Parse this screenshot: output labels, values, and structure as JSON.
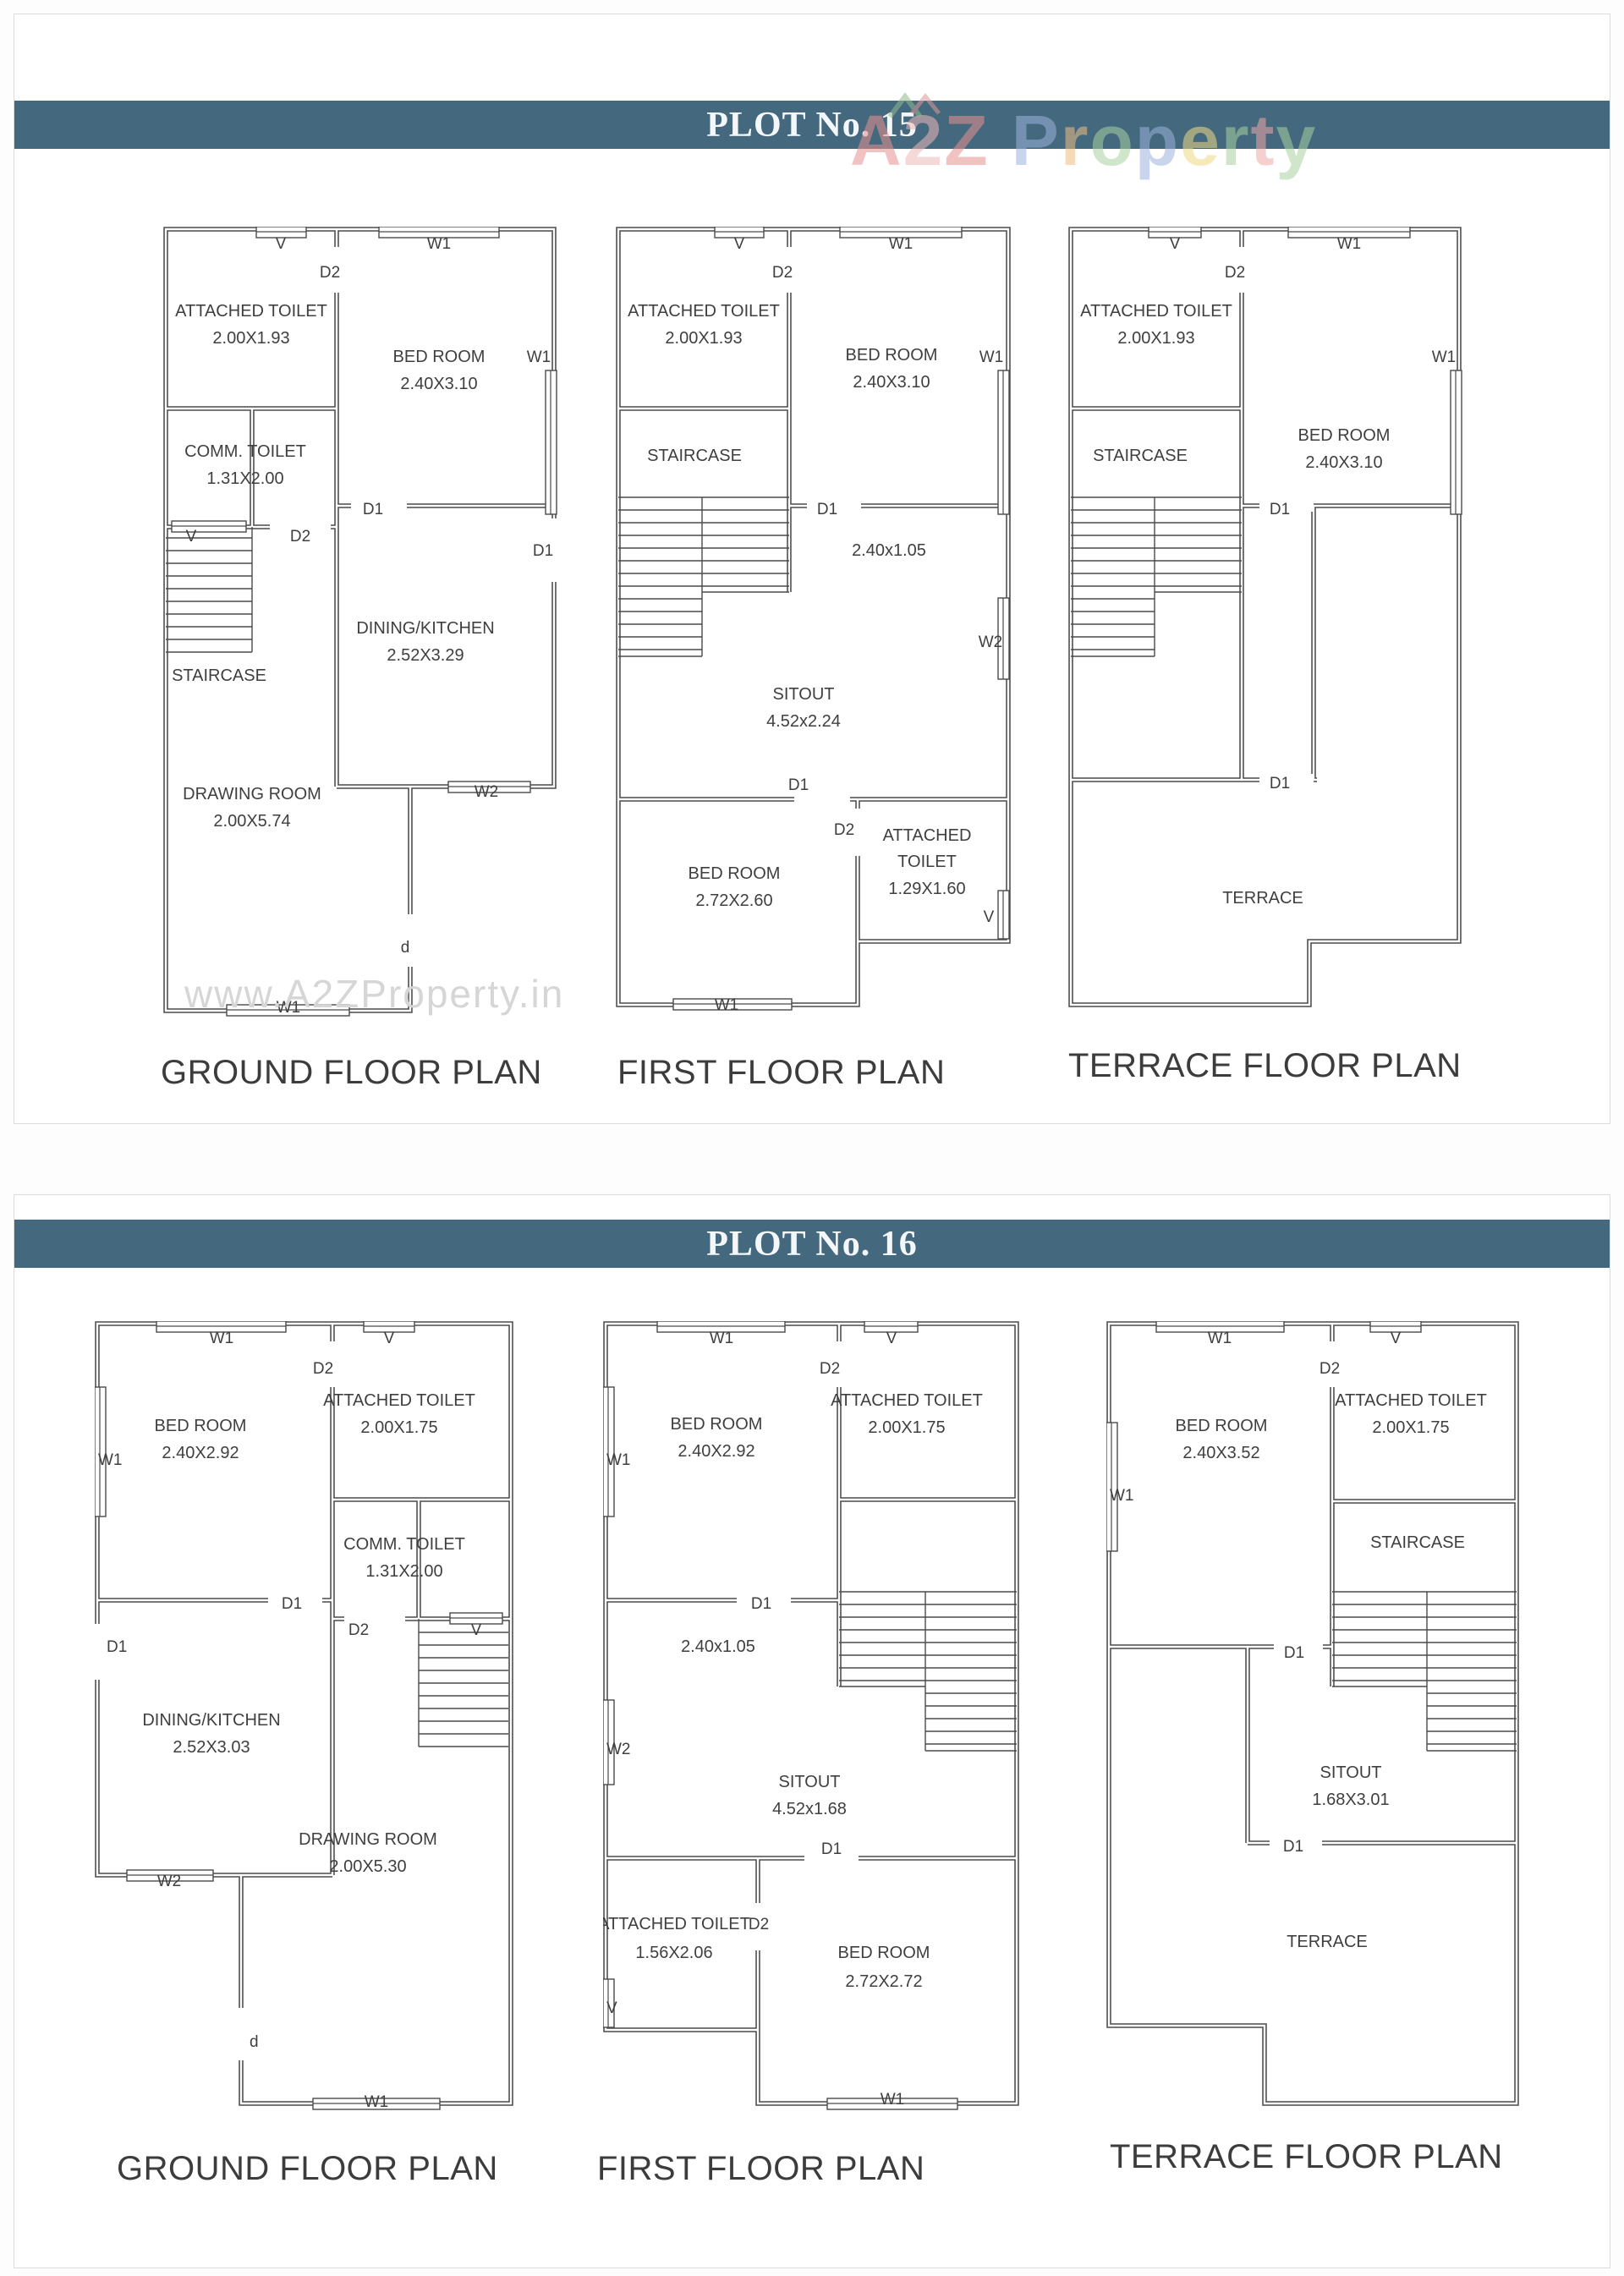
{
  "colors": {
    "header_bar": "#44687e",
    "header_text": "#f4f7f9",
    "wall": "#4a4a4a",
    "label": "#3f3f3f",
    "watermark": "#d6d6d6",
    "border": "#dcdcdc"
  },
  "markers": {
    "w1": "W1",
    "w2": "W2",
    "v": "V",
    "d1": "D1",
    "d2": "D2",
    "d": "d"
  },
  "watermark": "www.A2ZProperty.in",
  "logo": {
    "a2z": [
      "A",
      "2",
      "Z"
    ],
    "property": [
      "P",
      "r",
      "o",
      "p",
      "e",
      "r",
      "t",
      "y"
    ]
  },
  "plot15": {
    "header": "PLOT No. 15",
    "ground": {
      "title": "GROUND FLOOR PLAN",
      "attached_toilet": "ATTACHED TOILET",
      "attached_toilet_dim": "2.00X1.93",
      "bed_room": "BED ROOM",
      "bed_room_dim": "2.40X3.10",
      "comm_toilet": "COMM. TOILET",
      "comm_toilet_dim": "1.31X2.00",
      "staircase": "STAIRCASE",
      "dining": "DINING/KITCHEN",
      "dining_dim": "2.52X3.29",
      "drawing": "DRAWING ROOM",
      "drawing_dim": "2.00X5.74"
    },
    "first": {
      "title": "FIRST FLOOR PLAN",
      "attached_toilet": "ATTACHED TOILET",
      "attached_toilet_dim": "2.00X1.93",
      "staircase": "STAIRCASE",
      "bed_room": "BED ROOM",
      "bed_room_dim": "2.40X3.10",
      "passage_dim": "2.40x1.05",
      "sitout": "SITOUT",
      "sitout_dim": "4.52x2.24",
      "bed_room2": "BED ROOM",
      "bed_room2_dim": "2.72X2.60",
      "attached_toilet2_line1": "ATTACHED",
      "attached_toilet2_line2": "TOILET",
      "attached_toilet2_dim": "1.29X1.60"
    },
    "terrace": {
      "title": "TERRACE FLOOR PLAN",
      "attached_toilet": "ATTACHED TOILET",
      "attached_toilet_dim": "2.00X1.93",
      "staircase": "STAIRCASE",
      "bed_room": "BED ROOM",
      "bed_room_dim": "2.40X3.10",
      "terrace": "TERRACE"
    }
  },
  "plot16": {
    "header": "PLOT No. 16",
    "ground": {
      "title": "GROUND FLOOR PLAN",
      "bed_room": "BED ROOM",
      "bed_room_dim": "2.40X2.92",
      "attached_toilet": "ATTACHED TOILET",
      "attached_toilet_dim": "2.00X1.75",
      "comm_toilet": "COMM. TOILET",
      "comm_toilet_dim": "1.31X2.00",
      "dining": "DINING/KITCHEN",
      "dining_dim": "2.52X3.03",
      "drawing": "DRAWING ROOM",
      "drawing_dim": "2.00X5.30"
    },
    "first": {
      "title": "FIRST FLOOR PLAN",
      "bed_room": "BED ROOM",
      "bed_room_dim": "2.40X2.92",
      "attached_toilet": "ATTACHED TOILET",
      "attached_toilet_dim": "2.00X1.75",
      "passage_dim": "2.40x1.05",
      "sitout": "SITOUT",
      "sitout_dim": "4.52x1.68",
      "attached_toilet2": "ATTACHED TOILET",
      "attached_toilet2_dim": "1.56X2.06",
      "bed_room2": "BED ROOM",
      "bed_room2_dim": "2.72X2.72"
    },
    "terrace": {
      "title": "TERRACE FLOOR PLAN",
      "bed_room": "BED ROOM",
      "bed_room_dim": "2.40X3.52",
      "attached_toilet": "ATTACHED TOILET",
      "attached_toilet_dim": "2.00X1.75",
      "staircase": "STAIRCASE",
      "sitout": "SITOUT",
      "sitout_dim": "1.68X3.01",
      "terrace": "TERRACE"
    }
  }
}
